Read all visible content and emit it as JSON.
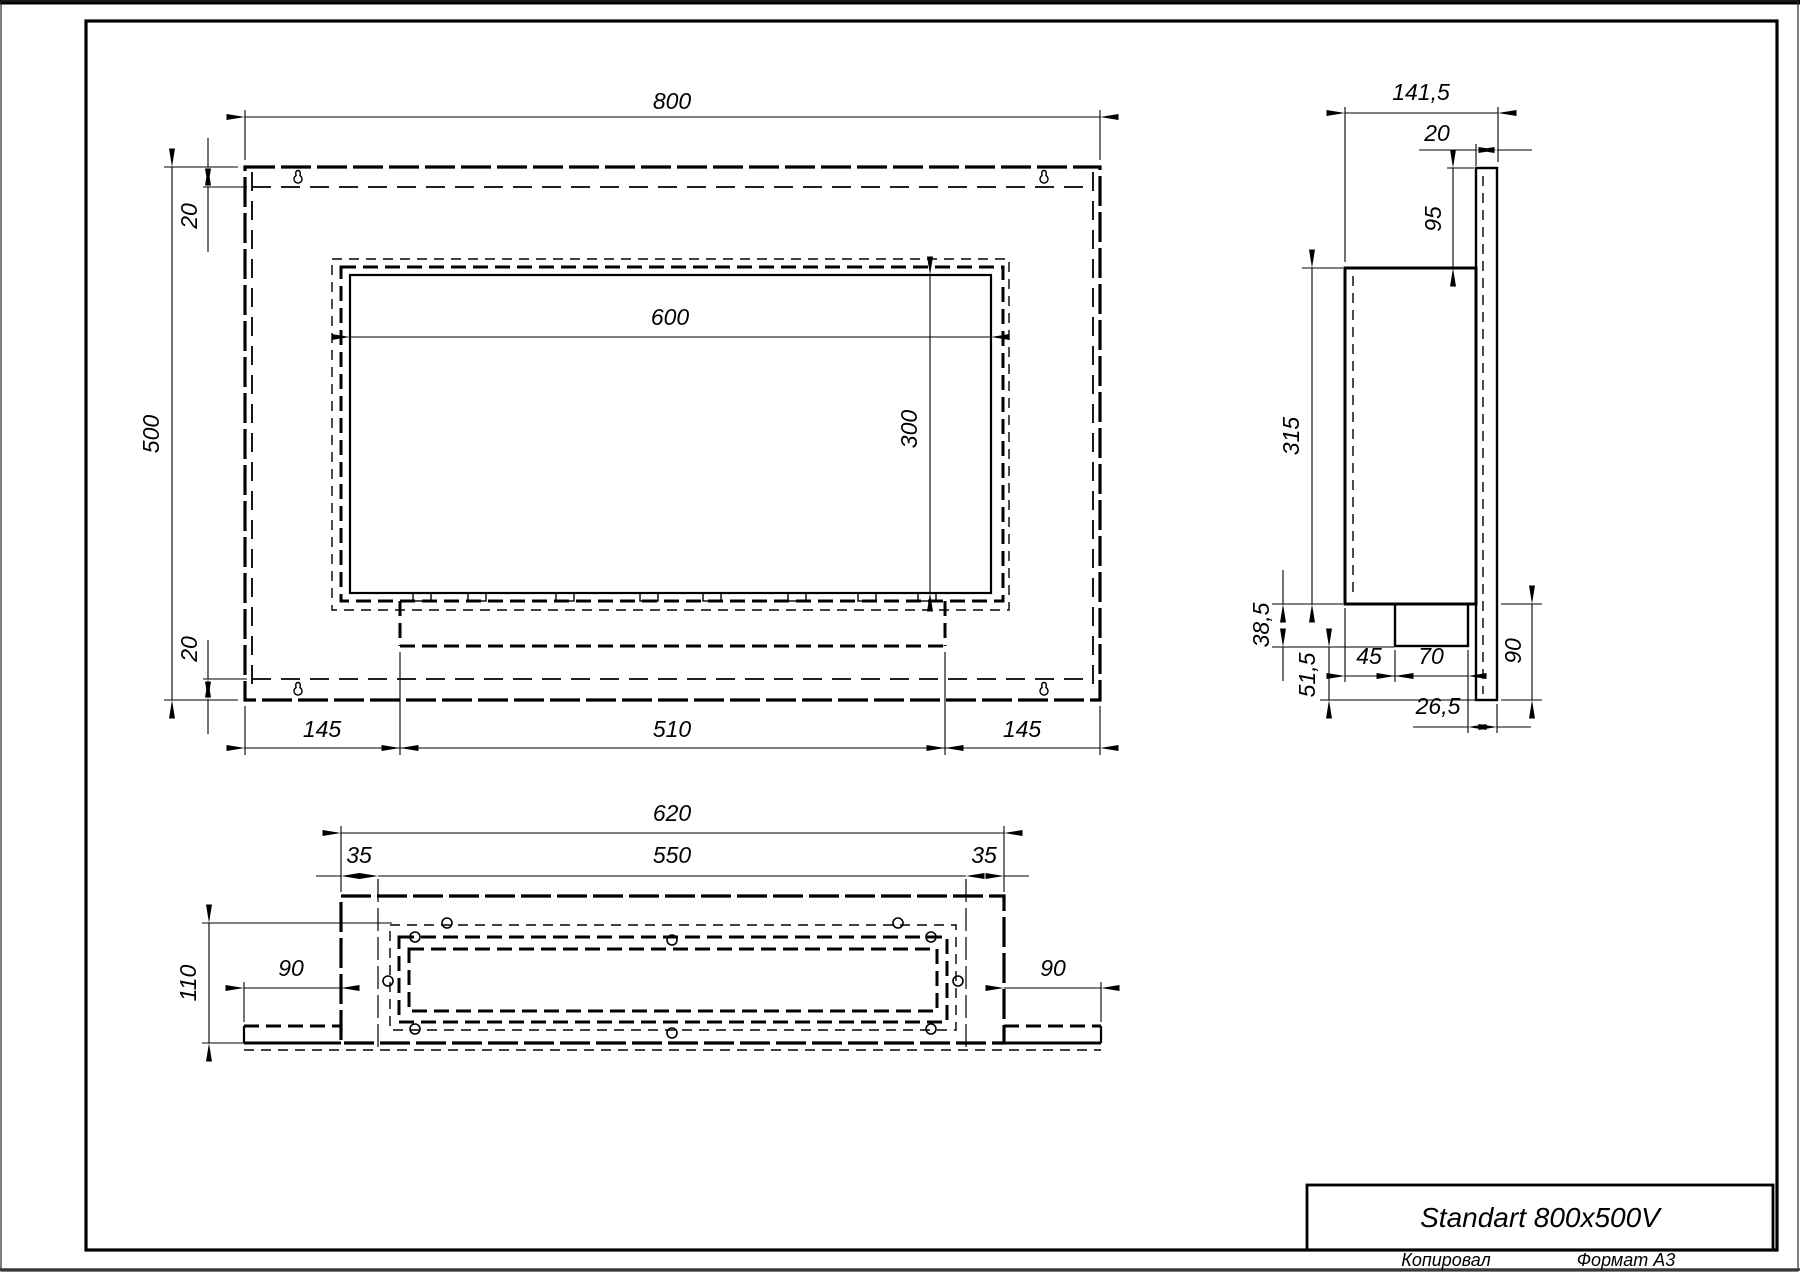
{
  "title_block": {
    "product_title": "Standart 800x500V"
  },
  "footer": {
    "copied_label": "Копировал",
    "format_label": "Формат A3"
  },
  "front_view": {
    "dims": {
      "overall_width": "800",
      "overall_height": "500",
      "top_inset": "20",
      "bottom_inset": "20",
      "opening_width": "600",
      "opening_height": "300",
      "left_offset": "145",
      "tray_width": "510",
      "right_offset": "145"
    }
  },
  "side_view": {
    "dims": {
      "overall_depth": "141,5",
      "plate_thickness": "20",
      "plate_top_extension": "95",
      "body_height": "315",
      "burner_drop": "38,5",
      "lower_drop": "51,5",
      "burner_offset": "45",
      "burner_depth": "70",
      "plate_bottom_extension": "90",
      "rear_clearance": "26,5"
    }
  },
  "bottom_view": {
    "dims": {
      "body_width": "620",
      "opening_width": "550",
      "left_flange": "35",
      "right_flange": "35",
      "body_depth": "110",
      "left_plate_extension": "90",
      "right_plate_extension": "90"
    }
  }
}
